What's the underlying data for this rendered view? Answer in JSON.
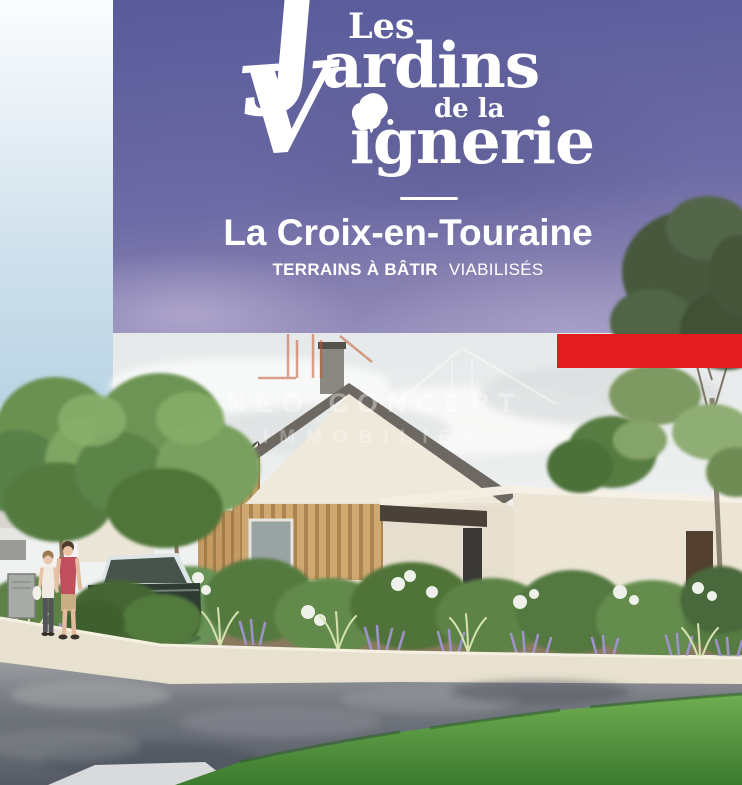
{
  "banner": {
    "logo": {
      "les": "Les",
      "initial_j": "J",
      "jardins_rest": "ardins",
      "de_la": "de la",
      "initial_v": "V",
      "vignerie_rest": "ignerie",
      "leaf_icon": "grape-leaf-icon"
    },
    "city": "La Croix-en-Touraine",
    "tagline_bold": "TERRAINS À BÂTIR",
    "tagline_regular": "VIABILISÉS"
  },
  "watermark": {
    "line1": "NEO CONCEPT",
    "line2": "IMMOBILIER"
  },
  "palette": {
    "banner_purple_top": "#585a9b",
    "banner_purple_bottom": "#9e97c1",
    "accent_red": "#e41c20",
    "text_white": "#ffffff",
    "sky_blue": "#b7d2e3",
    "house_cream": "#efe9db",
    "wood_cladding": "#c49a62",
    "roof_gray": "#6e6862",
    "foliage_green": "#5d8045",
    "lavender": "#9d92c9",
    "grass_green": "#4e8f3a",
    "road_asphalt": "#5f646e",
    "sidewalk_beige": "#e9e1cf"
  }
}
